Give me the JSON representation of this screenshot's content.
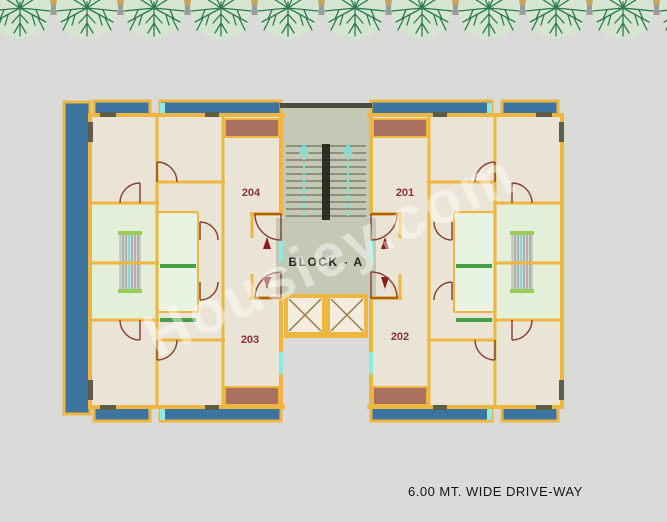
{
  "watermark": {
    "text": "Housiey.com"
  },
  "site": {
    "driveway_label": "6.00 MT. WIDE DRIVE-WAY",
    "trees": {
      "count": 11,
      "icon": "tree-canopy-icon"
    }
  },
  "plan": {
    "block_label": "BLOCK - A",
    "units": [
      {
        "id": "201",
        "label": "201",
        "position": "top-right"
      },
      {
        "id": "202",
        "label": "202",
        "position": "bottom-right"
      },
      {
        "id": "203",
        "label": "203",
        "position": "bottom-left"
      },
      {
        "id": "204",
        "label": "204",
        "position": "top-left"
      }
    ],
    "colors": {
      "background": "#dadad8",
      "wall": "#eeb63e",
      "floor": "#e9e4d6",
      "balcony_blue": "#3e74a0",
      "kitchen_green": "#e3efd9",
      "lobby_sage": "#c4c9b5",
      "accent_brown": "#a9705f",
      "accent_cyan": "#8ee9e4",
      "unit_label": "#8c2f3f",
      "arrow_red": "#8c1c1c",
      "stair_arrow_cyan": "#7ce0d8",
      "tree_canopy": "#d5e5d1",
      "tree_branch": "#2b7a55",
      "top_band": "#9c9c9c",
      "top_trim": "#c8a35a"
    }
  }
}
